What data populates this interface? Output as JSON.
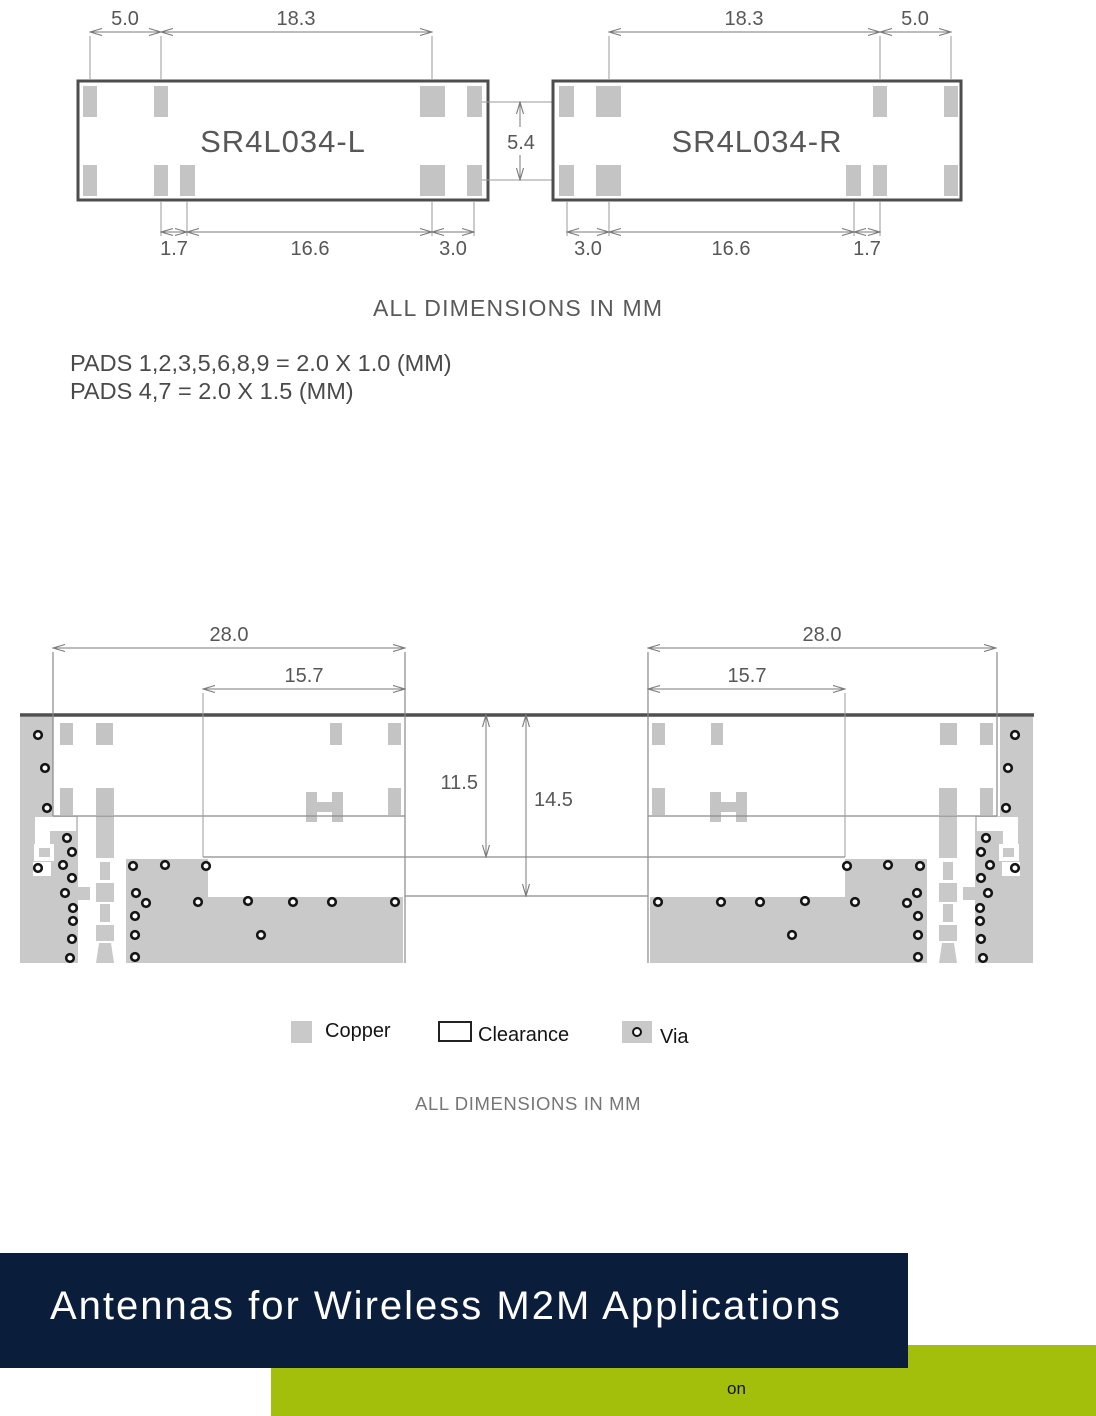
{
  "mechanical_drawing": {
    "note": "ALL DIMENSIONS IN MM",
    "pad_notes": {
      "line1": "PADS 1,2,3,5,6,8,9 = 2.0 X 1.0 (MM)",
      "line2": "PADS 4,7 = 2.0 X 1.5 (MM)"
    },
    "gap_dim": "5.4",
    "left_module": {
      "name": "SR4L034-L",
      "dim_top_1": "5.0",
      "dim_top_2": "18.3",
      "dim_bottom_1": "1.7",
      "dim_bottom_2": "16.6",
      "dim_bottom_3": "3.0"
    },
    "right_module": {
      "name": "SR4L034-R",
      "dim_top_1": "18.3",
      "dim_top_2": "5.0",
      "dim_bottom_1": "3.0",
      "dim_bottom_2": "16.6",
      "dim_bottom_3": "1.7"
    }
  },
  "footprint_drawing": {
    "note": "ALL DIMENSIONS IN MM",
    "left": {
      "dim_width": "28.0",
      "dim_inner": "15.7"
    },
    "right": {
      "dim_width": "28.0",
      "dim_inner": "15.7"
    },
    "dim_height_inner": "11.5",
    "dim_height_total": "14.5",
    "legend": {
      "copper": "Copper",
      "clearance": "Clearance",
      "via": "Via"
    },
    "colors": {
      "copper": "#c9c9c9",
      "pad": "#c4c4c4"
    },
    "vias_left": [
      [
        38,
        735
      ],
      [
        45,
        768
      ],
      [
        47,
        808
      ],
      [
        67,
        838
      ],
      [
        72,
        852
      ],
      [
        63,
        865
      ],
      [
        38,
        868
      ],
      [
        72,
        878
      ],
      [
        65,
        893
      ],
      [
        73,
        908
      ],
      [
        73,
        921
      ],
      [
        72,
        939
      ],
      [
        70,
        958
      ],
      [
        133,
        866
      ],
      [
        165,
        865
      ],
      [
        206,
        866
      ],
      [
        136,
        893
      ],
      [
        146,
        903
      ],
      [
        198,
        902
      ],
      [
        248,
        901
      ],
      [
        293,
        902
      ],
      [
        332,
        902
      ],
      [
        395,
        902
      ],
      [
        135,
        916
      ],
      [
        135,
        935
      ],
      [
        261,
        935
      ],
      [
        135,
        957
      ]
    ],
    "vias_right": [
      [
        1015,
        735
      ],
      [
        1008,
        768
      ],
      [
        1006,
        808
      ],
      [
        986,
        838
      ],
      [
        981,
        852
      ],
      [
        990,
        865
      ],
      [
        1015,
        868
      ],
      [
        981,
        878
      ],
      [
        988,
        893
      ],
      [
        980,
        908
      ],
      [
        980,
        921
      ],
      [
        981,
        939
      ],
      [
        983,
        958
      ],
      [
        920,
        866
      ],
      [
        888,
        865
      ],
      [
        847,
        866
      ],
      [
        917,
        893
      ],
      [
        907,
        903
      ],
      [
        855,
        902
      ],
      [
        805,
        901
      ],
      [
        760,
        902
      ],
      [
        721,
        902
      ],
      [
        658,
        902
      ],
      [
        918,
        916
      ],
      [
        918,
        935
      ],
      [
        792,
        935
      ],
      [
        918,
        957
      ]
    ]
  },
  "footer": {
    "title": "Antennas for Wireless M2M Applications",
    "overlay_text": "on",
    "colors": {
      "navy": "#0a1d3a",
      "green": "#a4be0c"
    }
  }
}
